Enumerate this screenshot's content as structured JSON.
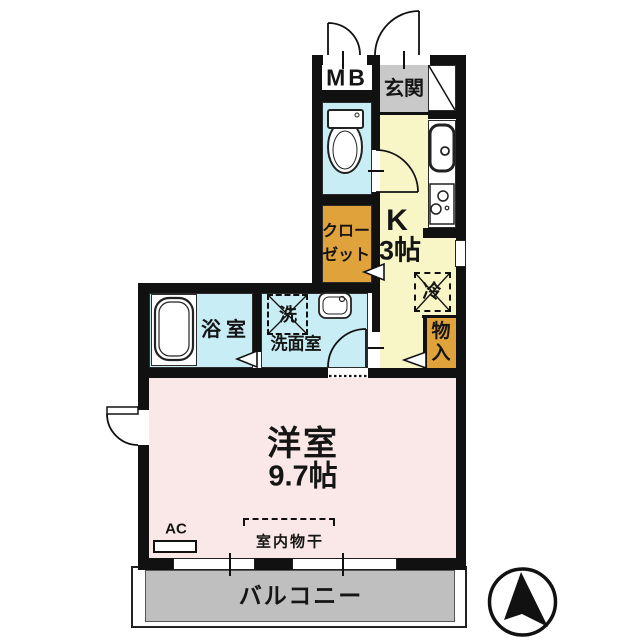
{
  "title": "studio-apartment-floor-plan",
  "colors": {
    "wall": "#111111",
    "wet_area_cyan": "#c9edf4",
    "kitchen_yellow": "#f8f6c6",
    "storage_orange": "#e0a33c",
    "entrance_gray": "#c9c9c9",
    "room_pink": "#fae8e8",
    "balcony_gray": "#bfbfbf"
  },
  "compass": {
    "direction": "north"
  },
  "rooms": {
    "meter_box": {
      "label": "MB"
    },
    "entrance": {
      "label": "玄関"
    },
    "kitchen": {
      "label": "K",
      "size": "3帖"
    },
    "closet": {
      "label_line1": "クロー",
      "label_line2": "ゼット"
    },
    "refrigerator_space": {
      "label": "冷"
    },
    "storage": {
      "label": "物入"
    },
    "bathroom": {
      "label": "浴室"
    },
    "washer_space": {
      "label": "洗"
    },
    "washroom": {
      "label": "洗面室"
    },
    "western_room": {
      "label": "洋室",
      "size": "9.7帖"
    },
    "air_conditioner": {
      "label": "AC"
    },
    "indoor_drying": {
      "label": "室内物干"
    },
    "balcony": {
      "label": "バルコニー"
    }
  }
}
